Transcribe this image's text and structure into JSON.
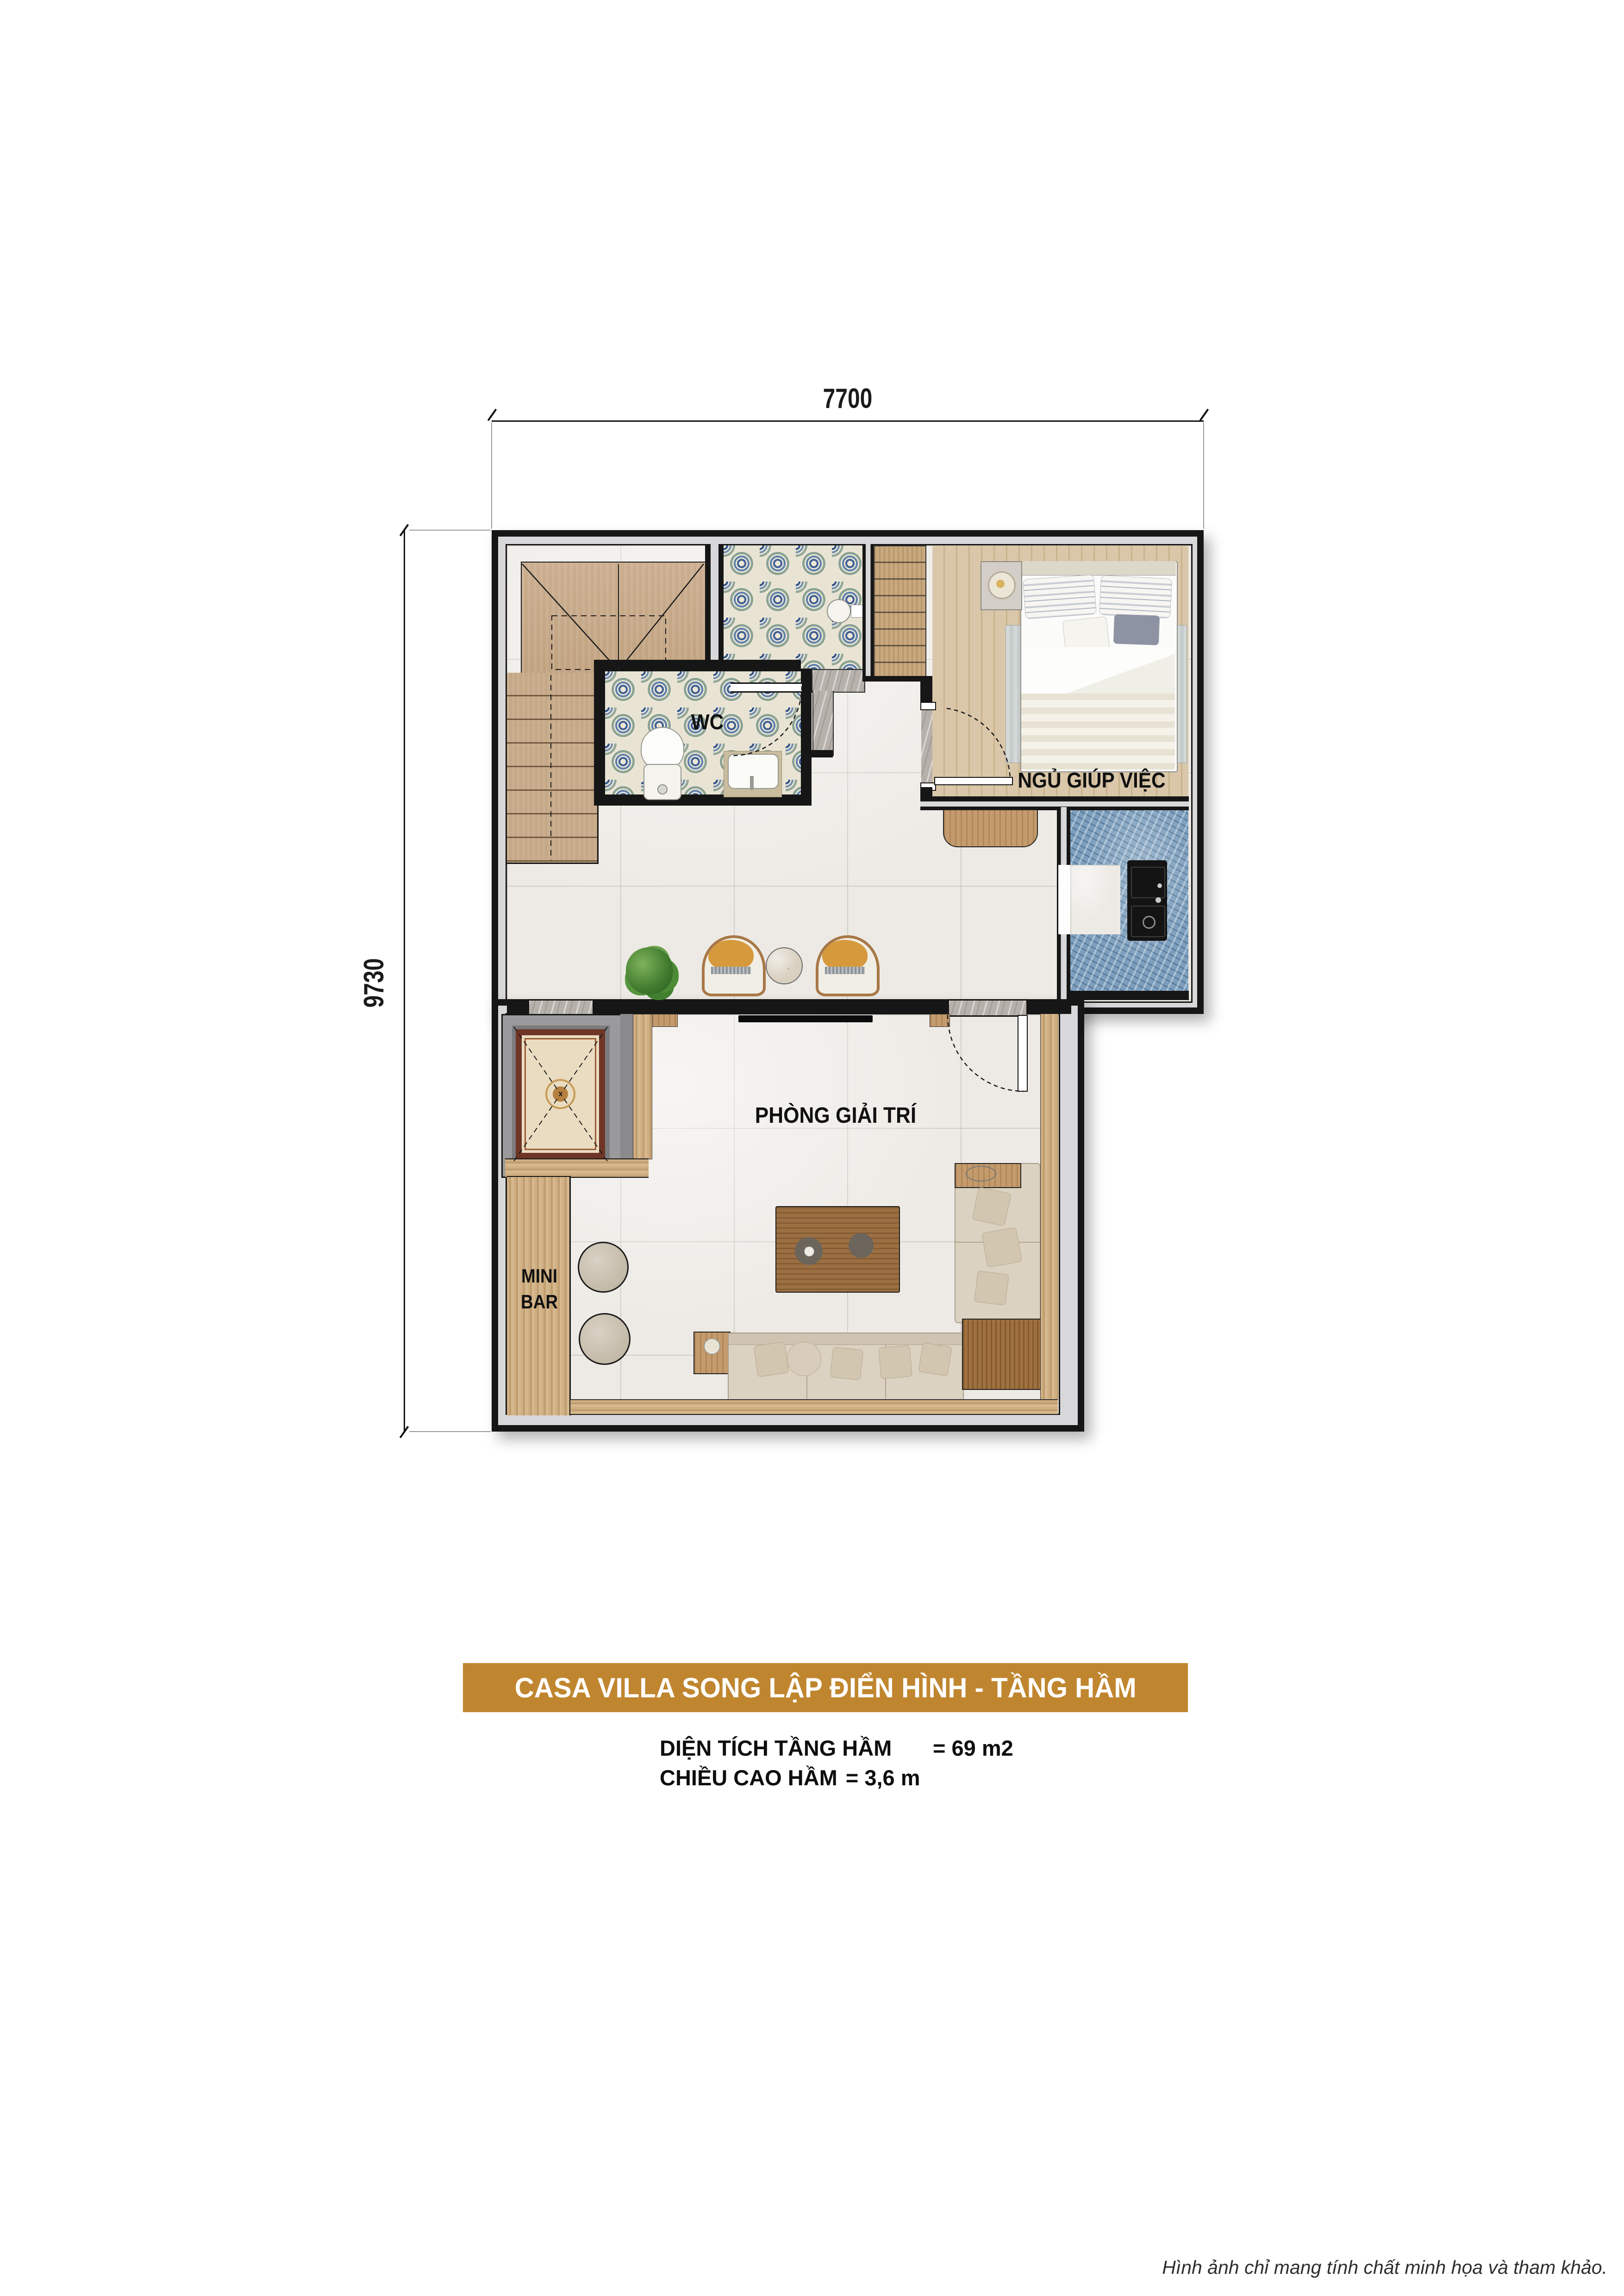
{
  "dimensions": {
    "width_label": "7700",
    "height_label": "9730"
  },
  "rooms": {
    "wc_label": "WC",
    "maid_label": "NGỦ GIÚP VIỆC",
    "entertainment_label": "PHÒNG GIẢI TRÍ",
    "minibar_label_line1": "MINI",
    "minibar_label_line2": "BAR"
  },
  "banner": {
    "title": "CASA VILLA SONG LẬP ĐIỂN HÌNH - TẦNG HẦM"
  },
  "specs": {
    "area_label": "DIỆN TÍCH TẦNG HẦM",
    "area_value": "= 69 m2",
    "height_label": "CHIỀU CAO HẦM",
    "height_value": "= 3,6 m"
  },
  "footer": {
    "disclaimer": "Hình ảnh chỉ mang tính chất minh họa và tham khảo."
  },
  "colors": {
    "banner_bg": "#c0862f",
    "banner_text": "#ffffff",
    "wall_black": "#161616",
    "wall_gray": "#d8d8da",
    "floor_tile": "#edeae5",
    "wc_tile_blue": "#3d5f94",
    "wc_tile_teal": "#8ba394",
    "counter_marble_blue": "#7d9fbd",
    "stair_wood": "#c8ab8c",
    "bedroom_wood": "#d6c2a3",
    "bar_wood": "#c9a87c",
    "sofa_beige": "#dcd2c1",
    "accent_chair_mustard": "#d69a3d",
    "elevator_rug_cream": "#e9dcc1",
    "elevator_rug_maroon": "#6e3526",
    "dimension_text": "#1a1a1a"
  }
}
